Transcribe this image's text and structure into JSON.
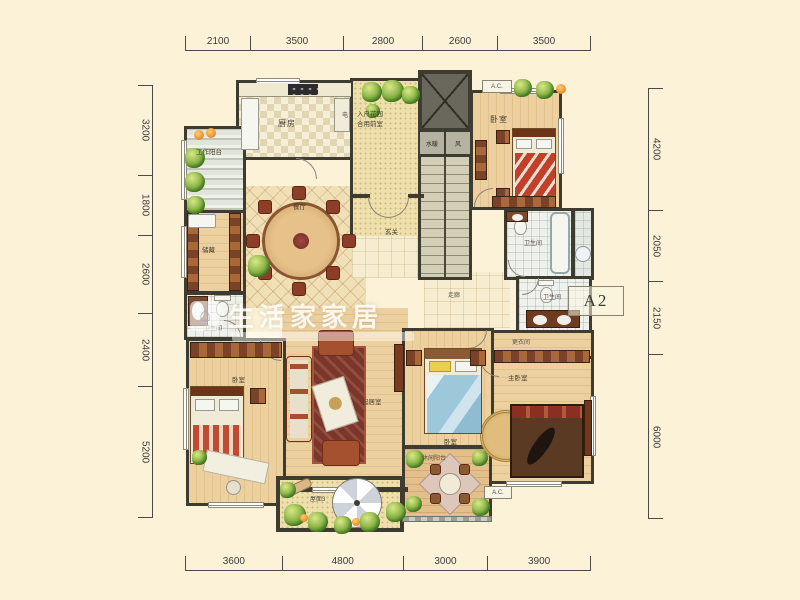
{
  "unit": {
    "label": "A2"
  },
  "watermark": {
    "text": "生活家家居",
    "icon": "house-icon"
  },
  "dimensions": {
    "top": [
      "2100",
      "3500",
      "2800",
      "2600",
      "3500"
    ],
    "bottom": [
      "3600",
      "4800",
      "3000",
      "3900"
    ],
    "left": [
      "3200",
      "1800",
      "2600",
      "2400",
      "5200"
    ],
    "right": [
      "4200",
      "2050",
      "2150",
      "6000"
    ]
  },
  "labels": {
    "kitchen": "厨房",
    "work_balcony": "工作阳台",
    "entry_garden_line1": "入户花园",
    "entry_garden_line2": "合用前室",
    "utility_water": "水暖",
    "utility_air": "风",
    "electric": "电",
    "ac_top": "A.C.",
    "ac_bottom": "A.C.",
    "bedroom_ne": "卧室",
    "storage": "储藏",
    "dining": "餐厅",
    "foyer": "玄关",
    "corridor": "走廊",
    "bath_ne": "卫生间",
    "bath_e": "卫生间",
    "dressing": "更衣间",
    "master_bedroom": "主卧室",
    "bedroom_center": "卧室",
    "leisure_balcony": "休闲阳台",
    "living_room": "起居室",
    "bedroom_sw": "卧室",
    "bath_w": "卫生间",
    "roof_terrace": "屋面3"
  },
  "colors": {
    "background": "#fbf2d8",
    "wall": "#3e3b31",
    "wood_floor": "#e8cb96",
    "tile_floor": "#f1dfb6",
    "plant_green": "#7fae41",
    "sofa_red": "#a5502e",
    "dimension_line": "#4a4a4a"
  }
}
